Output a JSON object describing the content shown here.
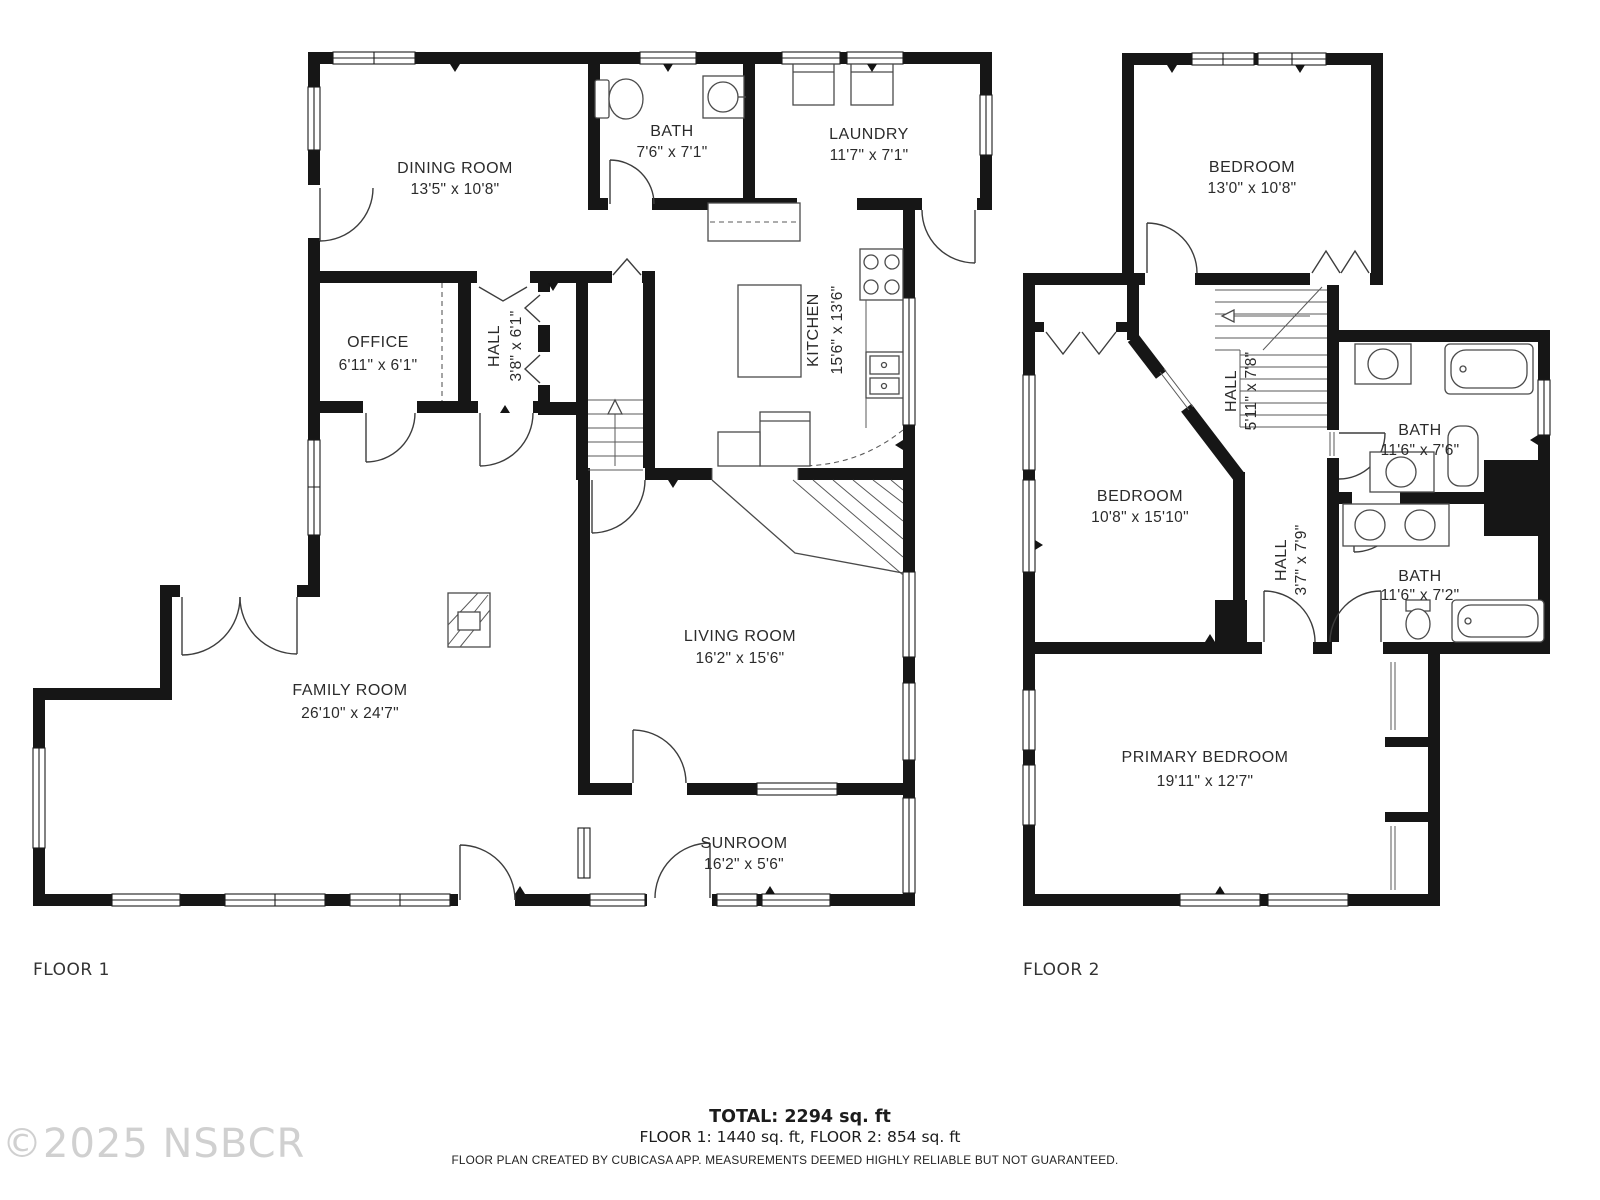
{
  "floor1": {
    "label": "FLOOR 1",
    "rooms": {
      "dining": {
        "name": "DINING ROOM",
        "dims": "13'5\" x 10'8\""
      },
      "bath": {
        "name": "BATH",
        "dims": "7'6\" x 7'1\""
      },
      "laundry": {
        "name": "LAUNDRY",
        "dims": "11'7\" x 7'1\""
      },
      "office": {
        "name": "OFFICE",
        "dims": "6'11\" x 6'1\""
      },
      "hall": {
        "name": "HALL",
        "dims": "3'8\" x 6'1\""
      },
      "kitchen": {
        "name": "KITCHEN",
        "dims": "15'6\" x 13'6\""
      },
      "family": {
        "name": "FAMILY ROOM",
        "dims": "26'10\" x 24'7\""
      },
      "living": {
        "name": "LIVING ROOM",
        "dims": "16'2\" x 15'6\""
      },
      "sunroom": {
        "name": "SUNROOM",
        "dims": "16'2\" x 5'6\""
      }
    }
  },
  "floor2": {
    "label": "FLOOR 2",
    "rooms": {
      "bedroom1": {
        "name": "BEDROOM",
        "dims": "13'0\" x 10'8\""
      },
      "hall1": {
        "name": "HALL",
        "dims": "5'11\" x 7'8\""
      },
      "bath1": {
        "name": "BATH",
        "dims": "11'6\" x 7'6\""
      },
      "bedroom2": {
        "name": "BEDROOM",
        "dims": "10'8\" x 15'10\""
      },
      "hall2": {
        "name": "HALL",
        "dims": "3'7\" x 7'9\""
      },
      "bath2": {
        "name": "BATH",
        "dims": "11'6\" x 7'2\""
      },
      "primary": {
        "name": "PRIMARY BEDROOM",
        "dims": "19'11\" x 12'7\""
      }
    }
  },
  "footer": {
    "total": "TOTAL: 2294 sq. ft",
    "floors": "FLOOR 1: 1440 sq. ft, FLOOR 2: 854 sq. ft",
    "disclaimer": "FLOOR PLAN CREATED BY CUBICASA APP. MEASUREMENTS DEEMED HIGHLY RELIABLE BUT NOT GUARANTEED."
  },
  "watermark": "©2025 NSBCR"
}
